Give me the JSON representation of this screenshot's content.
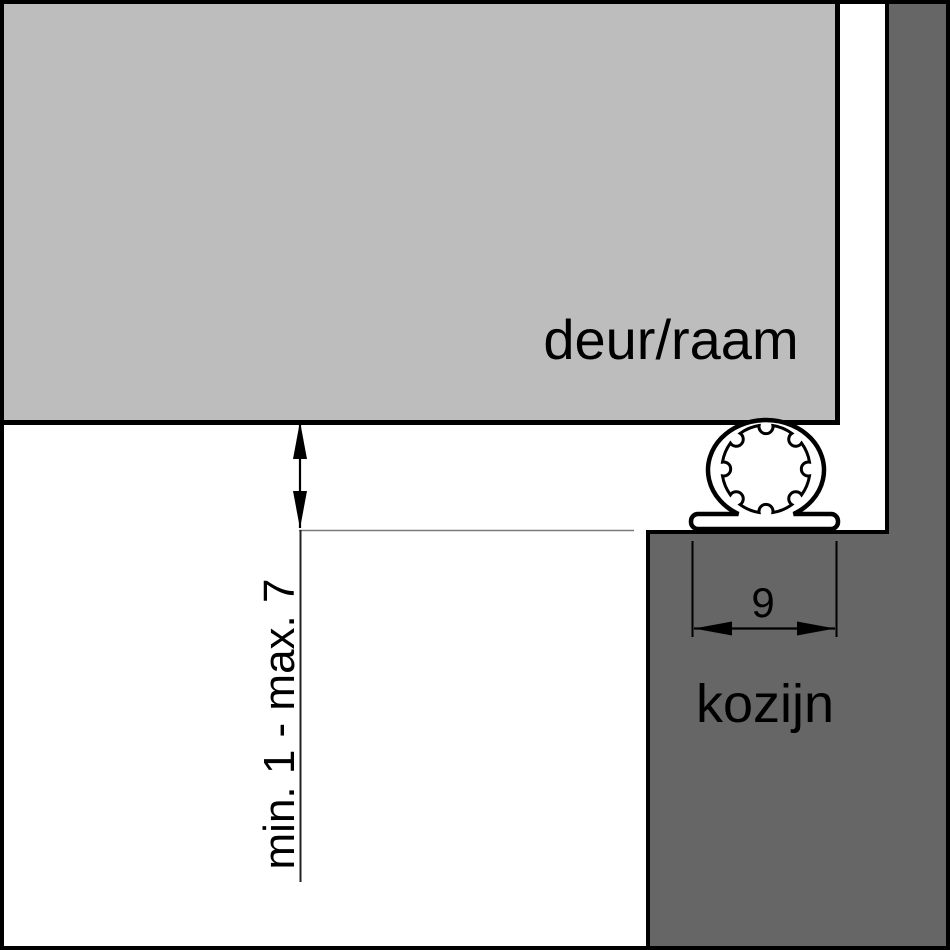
{
  "diagram": {
    "type": "technical-cross-section",
    "door_label": "deur/raam",
    "frame_label": "kozijn",
    "groove_width_label": "9",
    "gap_range_label": "min. 1 - max. 7",
    "colors": {
      "door_fill": "#bdbdbd",
      "frame_fill": "#666666",
      "outline": "#000000",
      "background": "#ffffff",
      "reference_line": "#7a7a7a"
    }
  }
}
